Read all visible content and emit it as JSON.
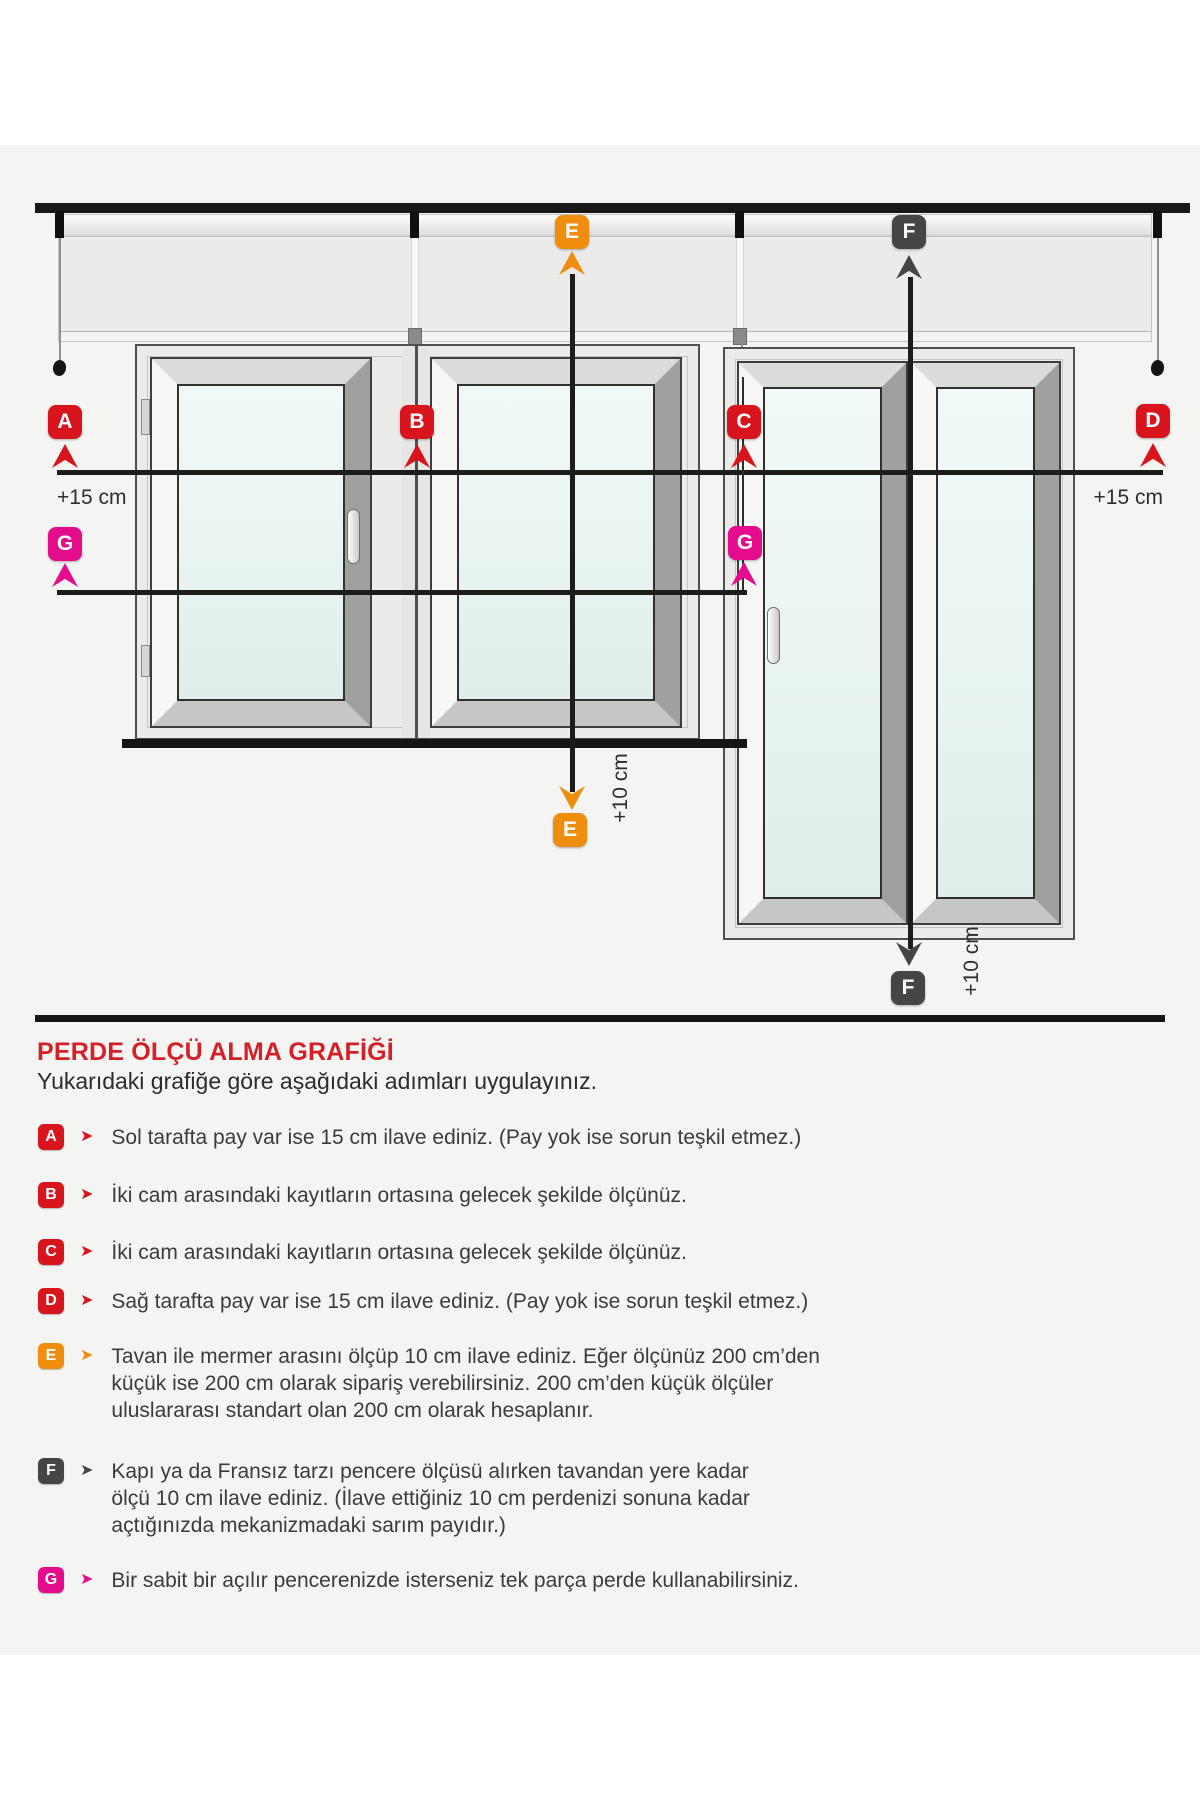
{
  "diagram": {
    "markers": {
      "a": "A",
      "b": "B",
      "c": "C",
      "d": "D",
      "e": "E",
      "f": "F",
      "g": "G"
    },
    "labels": {
      "plus15_left": "+15 cm",
      "plus15_right": "+15 cm",
      "plus10_e": "+10 cm",
      "plus10_f": "+10 cm"
    }
  },
  "legend": {
    "title": "PERDE ÖLÇÜ ALMA GRAFİĞİ",
    "subtitle": "Yukarıdaki grafiğe göre aşağıdaki adımları uygulayınız.",
    "items": [
      {
        "key": "A",
        "color": "#d8141c",
        "text": "Sol tarafta pay var ise 15 cm ilave ediniz. (Pay yok ise sorun teşkil etmez.)"
      },
      {
        "key": "B",
        "color": "#d8141c",
        "text": "İki cam arasındaki kayıtların ortasına gelecek şekilde ölçünüz."
      },
      {
        "key": "C",
        "color": "#d8141c",
        "text": "İki cam arasındaki kayıtların ortasına gelecek şekilde ölçünüz."
      },
      {
        "key": "D",
        "color": "#d8141c",
        "text": "Sağ tarafta pay var ise 15 cm ilave ediniz. (Pay yok ise sorun teşkil etmez.)"
      },
      {
        "key": "E",
        "color": "#ef8e0e",
        "text": "Tavan ile mermer arasını ölçüp 10 cm ilave ediniz. Eğer ölçünüz 200 cm’den\nküçük ise 200 cm olarak sipariş verebilirsiniz. 200 cm’den küçük ölçüler\nuluslararası standart olan 200 cm olarak hesaplanır."
      },
      {
        "key": "F",
        "color": "#454543",
        "text": "Kapı ya da Fransız tarzı pencere ölçüsü alırken tavandan yere kadar\nölçü 10 cm ilave ediniz. (İlave ettiğiniz 10 cm perdenizi sonuna kadar\naçtığınızda mekanizmadaki sarım payıdır.)"
      },
      {
        "key": "G",
        "color": "#e40b8d",
        "text": "Bir sabit bir açılır pencerenizde isterseniz tek parça perde kullanabilirsiniz."
      }
    ]
  },
  "colors": {
    "red": "#d8141c",
    "orange": "#ef8e0e",
    "dark": "#454543",
    "magenta": "#e40b8d",
    "line": "#1c1c1a",
    "title_red": "#d32127",
    "background": "#f4f4f3"
  }
}
